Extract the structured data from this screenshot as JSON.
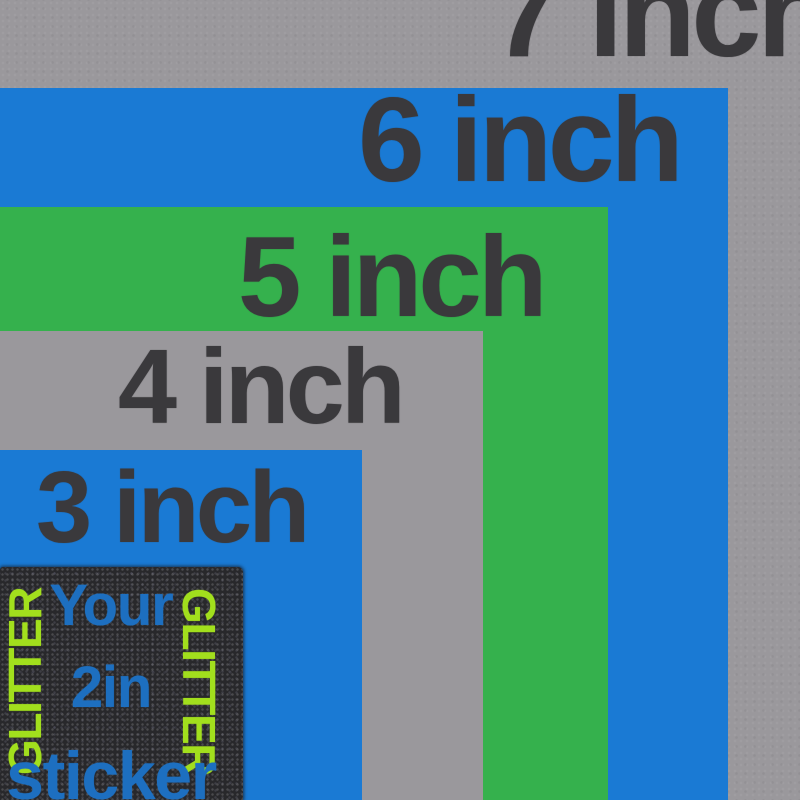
{
  "meta": {
    "description": "Glitter sticker size comparison chart with nested squares"
  },
  "colors": {
    "background_gray": "#9a989c",
    "square_blue": "#1a7ad4",
    "square_green": "#35b14d",
    "sticker_black": "#28282b",
    "label_dark": "#3a393c",
    "sticker_blue_text": "#1d6fc0",
    "glitter_lime": "#a2df1d"
  },
  "layers": [
    {
      "label": "7 inch",
      "inches": 7,
      "color": "#9a989c"
    },
    {
      "label": "6 inch",
      "inches": 6,
      "color": "#1a7ad4"
    },
    {
      "label": "5 inch",
      "inches": 5,
      "color": "#35b14d"
    },
    {
      "label": "4 inch",
      "inches": 4,
      "color": "#9a989c"
    },
    {
      "label": "3 inch",
      "inches": 3,
      "color": "#1a7ad4"
    }
  ],
  "sticker": {
    "inches": 2,
    "lines": [
      "Your",
      "2in",
      "sticker"
    ],
    "glitter_left": "GLITTER",
    "glitter_right": "GLITTER"
  }
}
